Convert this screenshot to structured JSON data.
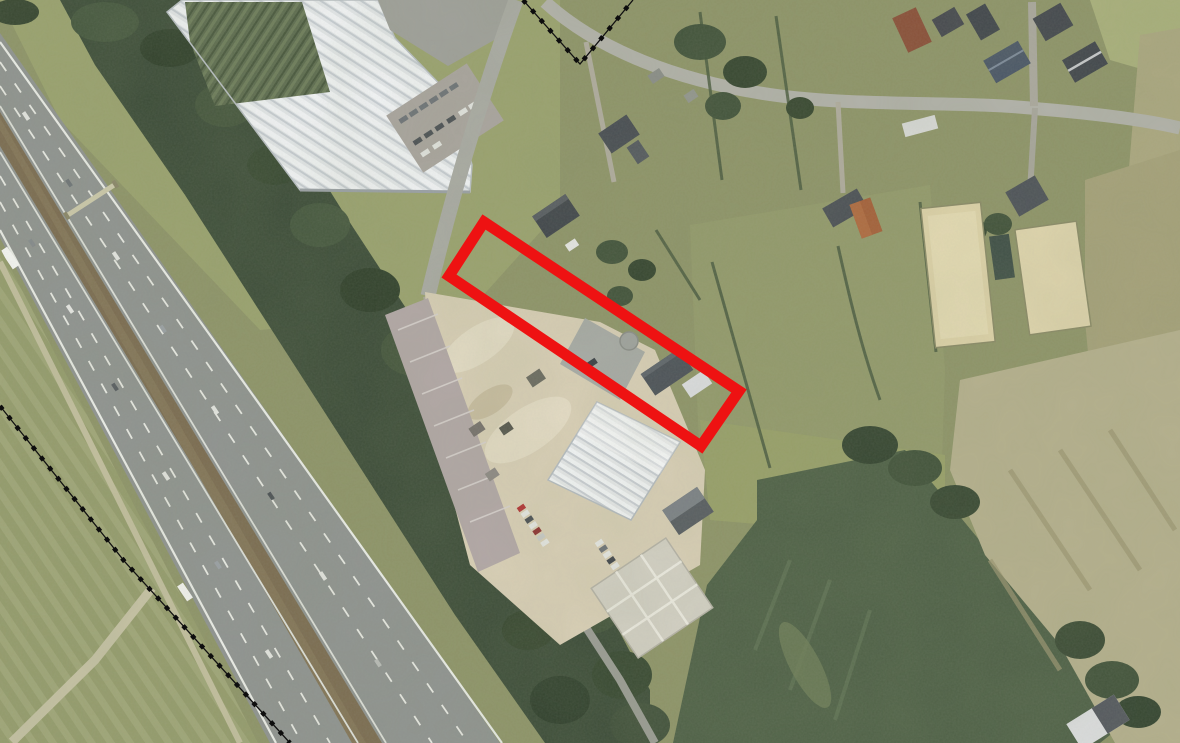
{
  "canvas": {
    "width": 1180,
    "height": 743
  },
  "colors": {
    "annotation_red": "#ee1212",
    "boundary_black": "#111111",
    "grass_base": "#8e9468"
  },
  "annotation": {
    "shape": "rotated-rectangle-outline",
    "points": "484,222 739,391 701,446 449,276",
    "stroke_width": 11
  },
  "boundary_lines": {
    "top_v": {
      "points": "523,0 580,64 633,0"
    },
    "bottom_diagonal": {
      "points": "0,406 125,562 290,743"
    },
    "dot_dash": "4.5 8.5",
    "base_width": 1.3,
    "dot_width": 4.5
  }
}
